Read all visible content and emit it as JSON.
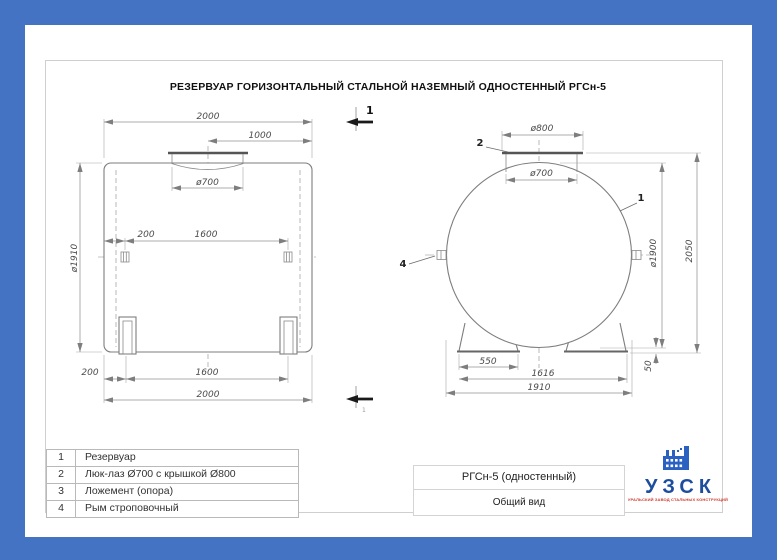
{
  "title": "РЕЗЕРВУАР ГОРИЗОНТАЛЬНЫЙ СТАЛЬНОЙ НАЗЕМНЫЙ ОДНОСТЕННЫЙ РГСн-5",
  "dims": {
    "side_top_length": "2000",
    "side_top_half": "1000",
    "side_manhole": "ø700",
    "side_shell_dia": "ø1910",
    "side_eye_offset": "200",
    "side_eye_spacing": "1600",
    "side_support_offset": "200",
    "side_support_spacing": "1600",
    "side_base_length": "2000",
    "end_cover": "ø800",
    "end_manhole": "ø700",
    "end_shell_dia": "ø1900",
    "end_height": "2050",
    "end_support_base": "550",
    "end_support_span": "1616",
    "end_width": "1910",
    "end_clearance": "50"
  },
  "callouts": {
    "shell": "1",
    "manhole": "2",
    "eye": "4"
  },
  "section": {
    "label": "1"
  },
  "parts_table": {
    "rows": [
      {
        "num": "1",
        "name": "Резервуар"
      },
      {
        "num": "2",
        "name": "Люк-лаз Ø700 с крышкой Ø800"
      },
      {
        "num": "3",
        "name": "Ложемент (опора)"
      },
      {
        "num": "4",
        "name": "Рым строповочный"
      }
    ]
  },
  "title_block": {
    "model": "РГСн-5 (одностенный)",
    "view": "Общий вид"
  },
  "logo": {
    "abbr": "УЗСК",
    "tagline": "УРАЛЬСКИЙ ЗАВОД СТАЛЬНЫХ КОНСТРУКЦИЙ"
  },
  "colors": {
    "border_blue": "#4573c4",
    "logo_blue": "#1d4e9e",
    "logo_red": "#cf3a2e"
  }
}
